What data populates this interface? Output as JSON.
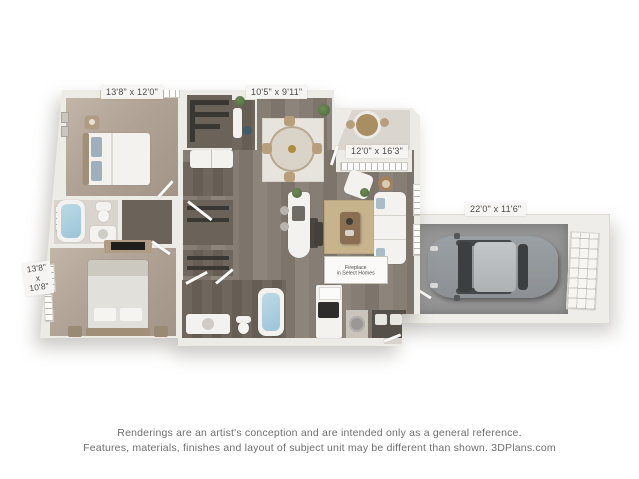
{
  "floorplan": {
    "labels": {
      "bedroom1": "13'8\" x 12'0\"",
      "dining": "10'5\" x 9'11\"",
      "living": "12'0\" x 16'3\"",
      "garage": "22'0\" x 11'6\"",
      "bedroom2_line1": "13'8\"",
      "bedroom2_line2": "x",
      "bedroom2_line3": "10'8\""
    },
    "fireplace_note": {
      "line1": "Fireplace",
      "line2": "in Select Homes"
    },
    "colors": {
      "wall": "#edebe6",
      "carpet": "#b0a295",
      "wood_floor": "#837a71",
      "dark_floor": "#6b6359",
      "garage_floor": "#959595",
      "tub_water": "#a3cbdc",
      "living_rug": "#c7b38c",
      "car_body": "#9aa0a3",
      "label_text": "#4b4b4b"
    }
  },
  "disclaimer": {
    "line1": "Renderings are an artist's conception and are intended only as a general reference.",
    "line2": "Features, materials, finishes and layout of subject unit may be different than shown. 3DPlans.com"
  }
}
